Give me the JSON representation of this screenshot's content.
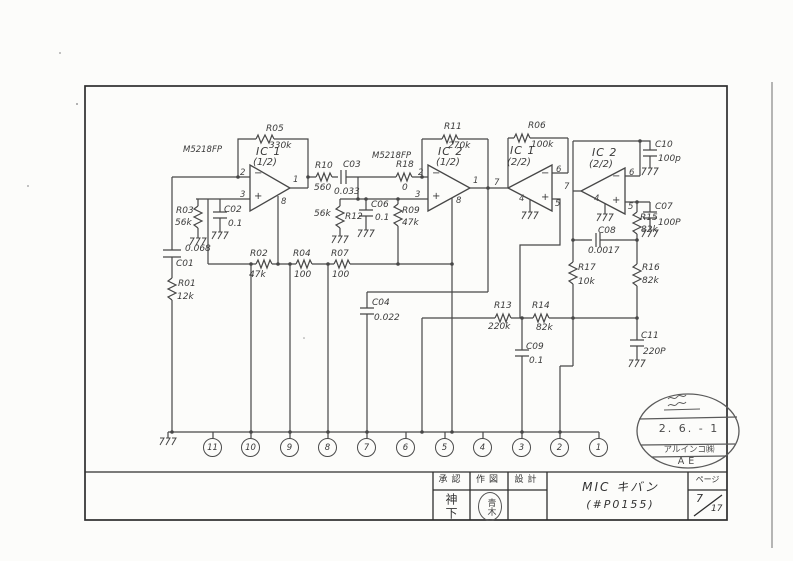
{
  "schematic": {
    "opamp_type": "M5218FP",
    "opamps": {
      "a": {
        "name": "IC 1",
        "half": "(1/2)",
        "pin_top": "2",
        "pin_bot": "3",
        "pin_out": "1",
        "pin_pwr": "8",
        "minus": "−",
        "plus": "+"
      },
      "b": {
        "name": "IC 2",
        "half": "(1/2)",
        "pin_top": "2",
        "pin_bot": "3",
        "pin_out": "1",
        "pin_pwr": "8",
        "minus": "−",
        "plus": "+"
      },
      "c": {
        "name": "IC 1",
        "half": "(2/2)",
        "pin_top": "6",
        "pin_bot": "5",
        "pin_out": "7",
        "pin_gnd": "4",
        "minus": "−",
        "plus": "+"
      },
      "d": {
        "name": "IC 2",
        "half": "(2/2)",
        "pin_top": "6",
        "pin_bot": "5",
        "pin_out": "7",
        "pin_gnd": "4",
        "minus": "−",
        "plus": "+"
      }
    },
    "parts": {
      "r01": {
        "ref": "R01",
        "val": "12k"
      },
      "r02": {
        "ref": "R02",
        "val": "47k"
      },
      "r03": {
        "ref": "R03",
        "val": "56k"
      },
      "r04": {
        "ref": "R04",
        "val": "100"
      },
      "r05": {
        "ref": "R05",
        "val": "330k"
      },
      "r06": {
        "ref": "R06",
        "val": "100k"
      },
      "r07": {
        "ref": "R07",
        "val": "100"
      },
      "r09": {
        "ref": "R09",
        "val": "47k"
      },
      "r10": {
        "ref": "R10",
        "val": "560"
      },
      "r11": {
        "ref": "R11",
        "val": "270k"
      },
      "r12": {
        "ref": "R12",
        "val": "56k"
      },
      "r13": {
        "ref": "R13",
        "val": "220k"
      },
      "r14": {
        "ref": "R14",
        "val": "82k"
      },
      "r15": {
        "ref": "R15",
        "val": "82k"
      },
      "r16": {
        "ref": "R16",
        "val": "82k"
      },
      "r17": {
        "ref": "R17",
        "val": "10k"
      },
      "r18": {
        "ref": "R18",
        "val": "0"
      },
      "c01": {
        "ref": "C01",
        "val": "0.068"
      },
      "c02": {
        "ref": "C02",
        "val": "0.1"
      },
      "c03": {
        "ref": "C03",
        "val": "0.033"
      },
      "c04": {
        "ref": "C04",
        "val": "0.022"
      },
      "c06": {
        "ref": "C06",
        "val": "0.1"
      },
      "c07": {
        "ref": "C07",
        "val": "100P"
      },
      "c08": {
        "ref": "C08",
        "val": "0.0017"
      },
      "c09": {
        "ref": "C09",
        "val": "0.1"
      },
      "c10": {
        "ref": "C10",
        "val": "100p"
      },
      "c11": {
        "ref": "C11",
        "val": "220P"
      }
    },
    "connector_pins": [
      "11",
      "10",
      "9",
      "8",
      "7",
      "6",
      "5",
      "4",
      "3",
      "2",
      "1"
    ]
  },
  "stamp": {
    "date": "2. 6. - 1",
    "company": "アルインコ㈱",
    "code": "AE"
  },
  "title_block": {
    "col1_header": "承認",
    "col2_header": "作図",
    "col3_header": "設計",
    "approver": "神下",
    "drafter": "青木",
    "title_line1": "MIC キバン",
    "title_line2": "(#P0155)",
    "page_label": "ページ",
    "page_no": "7",
    "page_total": "17"
  }
}
